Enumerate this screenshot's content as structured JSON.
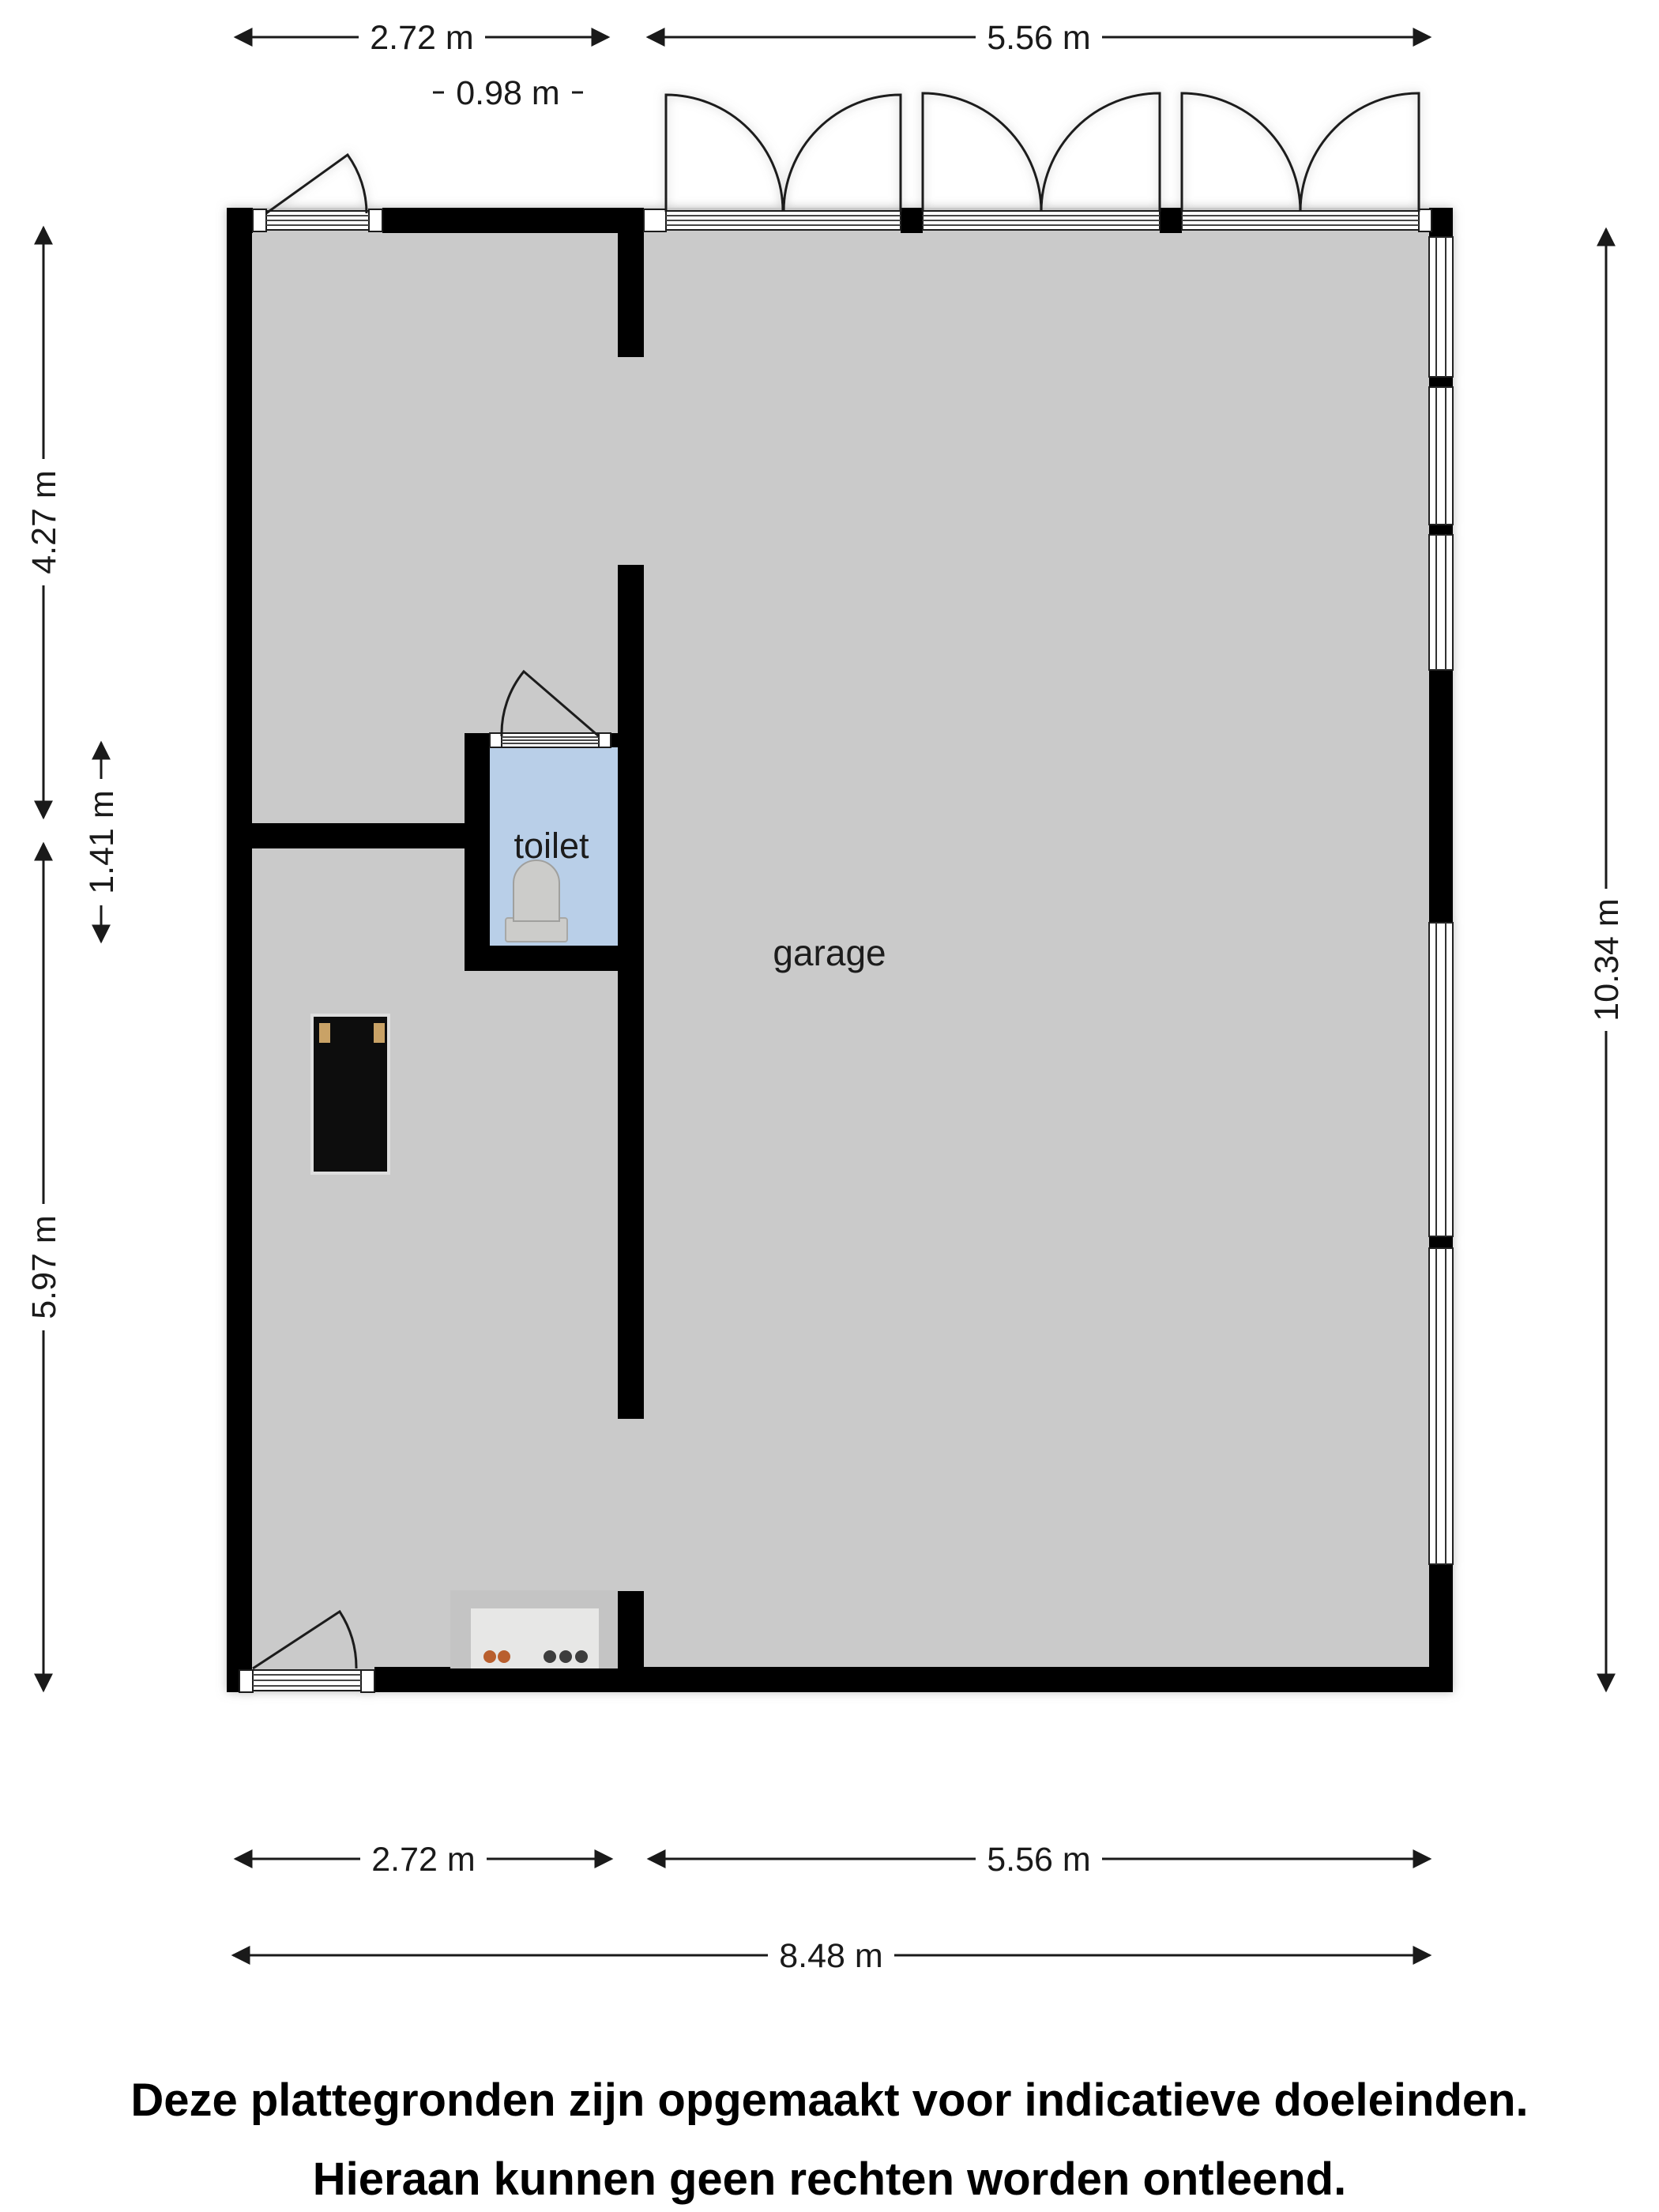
{
  "plan": {
    "type": "floor-plan",
    "rooms": {
      "garage": {
        "label": "garage"
      },
      "toilet": {
        "label": "toilet"
      }
    }
  },
  "dimensions": {
    "top": [
      {
        "label": "2.72 m"
      },
      {
        "label": "5.56 m"
      },
      {
        "label": "0.98 m"
      }
    ],
    "bottom": [
      {
        "label": "2.72 m"
      },
      {
        "label": "5.56 m"
      },
      {
        "label": "8.48 m"
      }
    ],
    "left": [
      {
        "label": "4.27 m"
      },
      {
        "label": "1.41 m"
      },
      {
        "label": "5.97 m"
      }
    ],
    "right": [
      {
        "label": "10.34 m"
      }
    ]
  },
  "disclaimer": {
    "line1": "Deze plattegronden zijn opgemaakt voor indicatieve doeleinden.",
    "line2": "Hieraan kunnen geen rechten worden ontleend."
  },
  "colors": {
    "wall": "#000000",
    "floor": "#cacaca",
    "toilet_floor": "#b9cfe8",
    "background": "#ffffff",
    "counter_frame": "#c4c4c4",
    "counter_inner": "#e7e7e6",
    "dot_orange": "#b95f2e",
    "dot_dark": "#3c3c3c",
    "cabinet": "#0a0a0a",
    "cabinet_hinge": "#c9a266",
    "fixture_gray": "#ccccca"
  }
}
